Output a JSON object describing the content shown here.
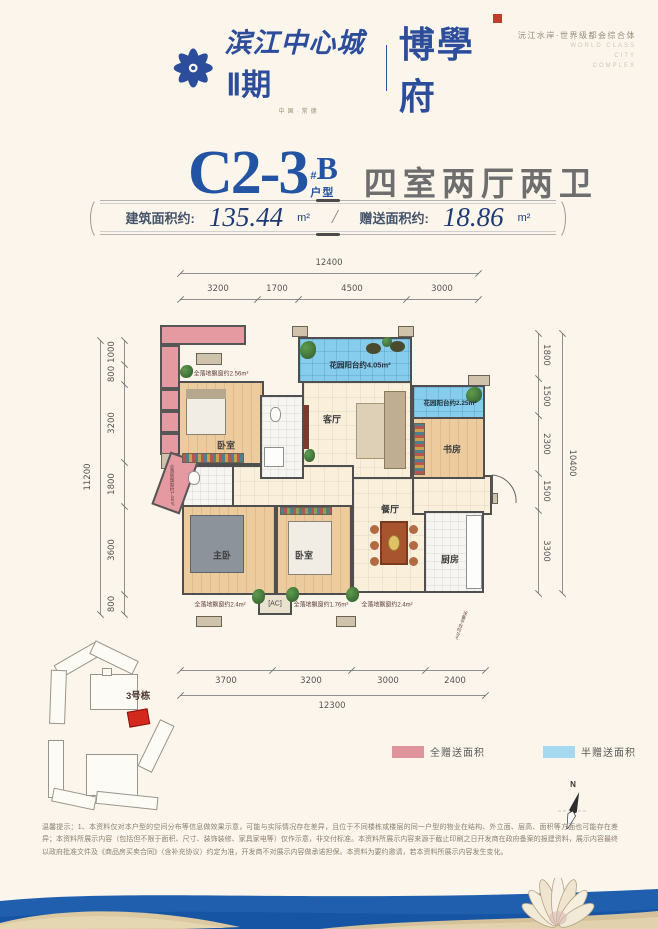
{
  "header": {
    "brand_cn": "滨江中心城",
    "brand_phase": "Ⅱ期",
    "brand_sub": "中国·常德",
    "brand_name": "博學府",
    "tagline_cn": "沅江水岸·世界级都会综合体",
    "tagline_en_1": "WORLD CLASS",
    "tagline_en_2": "CITY",
    "tagline_en_3": "COMPLEX"
  },
  "title": {
    "unit_code": "C2-3",
    "hash_mark": "#",
    "sub_code": "B",
    "unit_label": "户型",
    "layout_desc": "四室两厅两卫"
  },
  "area_bar": {
    "built_label": "建筑面积约:",
    "built_value": "135.44",
    "built_unit": "m²",
    "divider": "/",
    "gift_label": "赠送面积约:",
    "gift_value": "18.86",
    "gift_unit": "m²"
  },
  "plan": {
    "rooms": {
      "bedroom_top": "卧室",
      "living": "客厅",
      "study": "书房",
      "master": "主卧",
      "bedroom_bottom": "卧室",
      "dining": "餐厅",
      "kitchen": "厨房"
    },
    "balconies": {
      "top": "花园阳台约4.05m²",
      "right": "花园阳台约2.25m²"
    },
    "bays": {
      "top_left": "全落地飘窗约2.56m²",
      "left": "全落地飘窗约1.44m²",
      "bottom_left": "全落地飘窗约2.4m²",
      "bottom_mid": "全落地飘窗约1.76m²",
      "bottom_right": "全落地飘窗约2.4m²",
      "ac": "[AC]",
      "equipment": "设备平台约2m²"
    },
    "dims": {
      "top_total": "12400",
      "top_segments": [
        "3200",
        "1700",
        "4500",
        "3000"
      ],
      "left_total": "11200",
      "left_segments": [
        "1000",
        "800",
        "3200",
        "1800",
        "3600",
        "800"
      ],
      "right_total": "10400",
      "right_segments": [
        "1800",
        "1500",
        "2300",
        "1500",
        "3300"
      ],
      "bottom_total": "12300",
      "bottom_segments": [
        "3700",
        "3200",
        "3000",
        "2400"
      ]
    }
  },
  "site_plan": {
    "building_label": "3号栋"
  },
  "legend": {
    "full_gift_label": "全赠送面积",
    "half_gift_label": "半赠送面积",
    "full_gift_color": "#dd9399",
    "half_gift_color": "#a8d8f0"
  },
  "compass": {
    "north_label": "N"
  },
  "disclaimer": {
    "text": "温馨提示：1、本资料仅对本户型的空间分布等信息做效果示意，可能与实际情况存在差异，且位于不同楼栋或楼层的同一户型的物业在结构、外立面、层高、面积等方面也可能存在差异；本资料所展示内容（包括但不限于面积、尺寸、装饰装修、家具家电等）仅作示意，非交付标准。本资料所展示内容来源于截止印刷之日开发商在政府备案的报建资料，展示内容最终以政府批准文件及《商品房买卖合同》（含补充协议）约定为准，开发商不对展示内容做承诺担保。本资料为要约邀请，若本资料所展示内容发生变化。"
  },
  "colors": {
    "brand_blue": "#2b4d9b",
    "title_blue": "#2353a3",
    "seal_red": "#c43b2a",
    "balcony_blue": "#86ccec",
    "bay_pink": "#e49aa0",
    "highlight_red": "#d3291c",
    "sea_blue": "#1f5fae",
    "sand": "#d9c69f"
  }
}
